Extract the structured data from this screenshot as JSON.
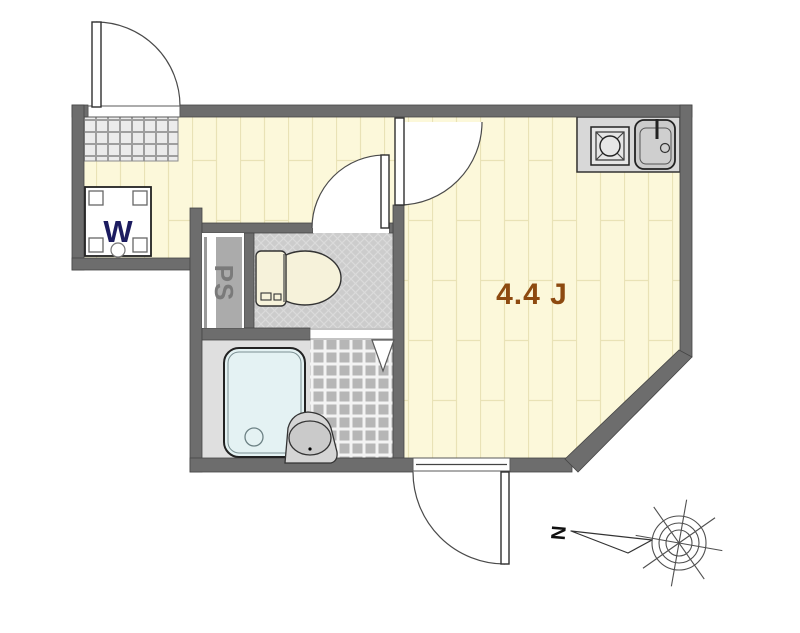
{
  "labels": {
    "room_size": "4.4 J",
    "washer": "W",
    "pipe_space": "PS",
    "compass_north": "N"
  },
  "colors": {
    "wall": "#6d6d6d",
    "wood_floor": "#fcf8da",
    "plank_line": "#e9e2b6",
    "genkan_tile": "#ececec",
    "toilet_floor": "#cccccc",
    "bath_tile": "#b6b6b6",
    "bath_floor": "#dfdfdf",
    "tub_fill": "#e4f2f3",
    "counter": "#d8d8d8",
    "room_label": "#8d4a10",
    "washer_label": "#1c1c60",
    "ps_strip": "#ababab",
    "ps_label": "#7a7a7a"
  }
}
